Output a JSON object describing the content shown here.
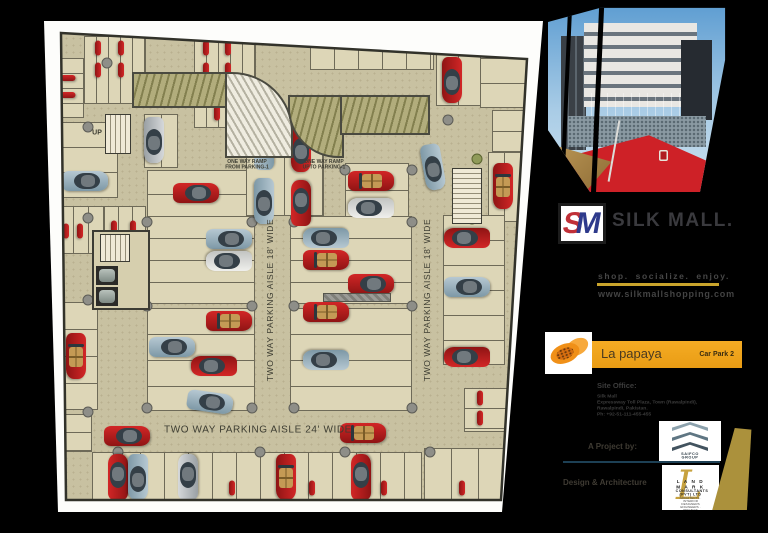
{
  "plan": {
    "aisle_labels": [
      {
        "text": "TWO WAY PARKING AISLE 18' WIDE",
        "x": 270,
        "y": 300,
        "rot": -90,
        "size": 8.5
      },
      {
        "text": "TWO WAY PARKING AISLE 18' WIDE",
        "x": 427,
        "y": 300,
        "rot": -90,
        "size": 8.5
      },
      {
        "text": "TWO WAY PARKING AISLE 24' WIDE",
        "x": 258,
        "y": 430,
        "rot": 0,
        "size": 10
      }
    ],
    "ramp_labels": [
      {
        "line1": "ONE WAY RAMP",
        "line2": "FROM PARKING-1",
        "x": 247,
        "y": 165
      },
      {
        "line1": "ONE WAY RAMP",
        "line2": "UPTO PARKING-1",
        "x": 324,
        "y": 165
      }
    ],
    "up_labels": [
      {
        "text": "UP",
        "x": 97,
        "y": 133
      },
      {
        "text": "UP",
        "x": 137,
        "y": 246
      },
      {
        "text": "UP",
        "x": 466,
        "y": 180
      }
    ],
    "banks": [
      [
        84,
        36,
        62,
        68,
        "v",
        12
      ],
      [
        194,
        36,
        62,
        92,
        "v",
        12
      ],
      [
        56,
        58,
        28,
        60,
        "h",
        15
      ],
      [
        56,
        122,
        62,
        76,
        "h",
        25
      ],
      [
        58,
        206,
        46,
        48,
        "v",
        15
      ],
      [
        104,
        206,
        42,
        48,
        "v",
        14
      ],
      [
        58,
        302,
        40,
        108,
        "h",
        27
      ],
      [
        56,
        414,
        36,
        38,
        "h",
        18
      ],
      [
        92,
        452,
        330,
        52,
        "v",
        24
      ],
      [
        424,
        448,
        82,
        54,
        "v",
        27
      ],
      [
        147,
        170,
        108,
        48,
        "h",
        24
      ],
      [
        144,
        114,
        34,
        54,
        "v",
        17
      ],
      [
        246,
        120,
        78,
        96,
        "v",
        38
      ],
      [
        345,
        163,
        64,
        94,
        "h",
        27
      ],
      [
        147,
        216,
        108,
        88,
        "h",
        22
      ],
      [
        290,
        216,
        122,
        88,
        "h",
        22
      ],
      [
        147,
        308,
        108,
        103,
        "h",
        26
      ],
      [
        290,
        308,
        122,
        103,
        "h",
        26
      ],
      [
        436,
        48,
        68,
        58,
        "v",
        22
      ],
      [
        480,
        58,
        52,
        50,
        "h",
        25
      ],
      [
        492,
        110,
        38,
        42,
        "h",
        21
      ],
      [
        488,
        152,
        34,
        70,
        "v",
        16
      ],
      [
        443,
        215,
        62,
        150,
        "h",
        25
      ],
      [
        464,
        388,
        44,
        44,
        "h",
        20
      ],
      [
        310,
        42,
        124,
        28,
        "v",
        24
      ]
    ],
    "vehicles": [
      [
        200,
        91,
        0,
        "conv",
        "red"
      ],
      [
        374,
        111,
        0,
        "sedan",
        "silver"
      ],
      [
        452,
        80,
        90,
        "sedan",
        "red"
      ],
      [
        154,
        140,
        90,
        "sedan",
        "silver"
      ],
      [
        503,
        186,
        90,
        "conv",
        "red"
      ],
      [
        264,
        147,
        270,
        "sedan",
        "blue"
      ],
      [
        301,
        149,
        90,
        "sedan",
        "red"
      ],
      [
        264,
        201,
        90,
        "sedan",
        "blue"
      ],
      [
        301,
        203,
        270,
        "sedan",
        "red"
      ],
      [
        371,
        181,
        0,
        "conv",
        "red"
      ],
      [
        371,
        208,
        180,
        "sedan",
        "white"
      ],
      [
        433,
        167,
        80,
        "sedan",
        "blue"
      ],
      [
        85,
        181,
        0,
        "sedan",
        "blue"
      ],
      [
        66,
        231,
        90,
        "bike",
        "red"
      ],
      [
        80,
        231,
        90,
        "bike",
        "red"
      ],
      [
        114,
        228,
        90,
        "bike",
        "red"
      ],
      [
        133,
        228,
        90,
        "bike",
        "red"
      ],
      [
        76,
        356,
        90,
        "conv",
        "red"
      ],
      [
        196,
        193,
        0,
        "sedan",
        "red"
      ],
      [
        229,
        239,
        0,
        "sedan",
        "blue"
      ],
      [
        229,
        261,
        180,
        "sedan",
        "white"
      ],
      [
        229,
        321,
        0,
        "conv",
        "red"
      ],
      [
        172,
        347,
        0,
        "sedan",
        "blue"
      ],
      [
        214,
        366,
        180,
        "sedan",
        "red"
      ],
      [
        326,
        238,
        180,
        "sedan",
        "blue"
      ],
      [
        326,
        260,
        0,
        "conv",
        "red"
      ],
      [
        326,
        312,
        0,
        "conv",
        "red"
      ],
      [
        326,
        360,
        180,
        "sedan",
        "blue"
      ],
      [
        371,
        284,
        0,
        "sedan",
        "red"
      ],
      [
        210,
        402,
        8,
        "sedan",
        "blue"
      ],
      [
        127,
        436,
        0,
        "sedan",
        "red"
      ],
      [
        363,
        433,
        0,
        "conv",
        "red"
      ],
      [
        467,
        238,
        180,
        "sedan",
        "red"
      ],
      [
        467,
        287,
        0,
        "sedan",
        "blue"
      ],
      [
        467,
        357,
        180,
        "sedan",
        "red"
      ],
      [
        480,
        398,
        90,
        "bike",
        "red"
      ],
      [
        480,
        418,
        90,
        "bike",
        "red"
      ],
      [
        118,
        477,
        270,
        "sedan",
        "red"
      ],
      [
        138,
        477,
        90,
        "sedan",
        "blue"
      ],
      [
        188,
        477,
        270,
        "sedan",
        "silver"
      ],
      [
        286,
        477,
        90,
        "conv",
        "red"
      ],
      [
        361,
        477,
        270,
        "sedan",
        "red"
      ],
      [
        232,
        488,
        90,
        "bike",
        "red"
      ],
      [
        312,
        488,
        90,
        "bike",
        "red"
      ],
      [
        384,
        488,
        90,
        "bike",
        "red"
      ],
      [
        462,
        488,
        90,
        "bike",
        "red"
      ],
      [
        98,
        48,
        90,
        "bike",
        "red"
      ],
      [
        121,
        48,
        90,
        "bike",
        "red"
      ],
      [
        98,
        70,
        90,
        "bike",
        "red"
      ],
      [
        121,
        70,
        90,
        "bike",
        "red"
      ],
      [
        206,
        48,
        90,
        "bike",
        "red"
      ],
      [
        228,
        48,
        90,
        "bike",
        "red"
      ],
      [
        206,
        70,
        90,
        "bike",
        "red"
      ],
      [
        228,
        70,
        90,
        "bike",
        "red"
      ],
      [
        217,
        93,
        90,
        "bike",
        "red"
      ],
      [
        217,
        113,
        90,
        "bike",
        "red"
      ],
      [
        68,
        78,
        0,
        "bike",
        "red"
      ],
      [
        68,
        95,
        0,
        "bike",
        "red"
      ]
    ],
    "columns": [
      [
        107,
        63
      ],
      [
        88,
        127
      ],
      [
        88,
        218
      ],
      [
        88,
        300
      ],
      [
        88,
        412
      ],
      [
        118,
        452
      ],
      [
        147,
        222
      ],
      [
        147,
        306
      ],
      [
        147,
        408
      ],
      [
        252,
        222
      ],
      [
        252,
        306
      ],
      [
        252,
        408
      ],
      [
        294,
        222
      ],
      [
        294,
        306
      ],
      [
        294,
        408
      ],
      [
        345,
        170
      ],
      [
        412,
        170
      ],
      [
        412,
        222
      ],
      [
        412,
        306
      ],
      [
        412,
        408
      ],
      [
        448,
        120
      ],
      [
        260,
        452
      ],
      [
        345,
        452
      ],
      [
        430,
        452
      ]
    ],
    "olive_columns": [
      [
        477,
        159
      ],
      [
        472,
        219
      ]
    ]
  },
  "panel": {
    "brand": {
      "monogram_s": "S",
      "monogram_m": "M",
      "name": "SILK MALL."
    },
    "tagline": "shop. socialize. enjoy.",
    "website": "www.silkmallshopping.com",
    "lapapaya": {
      "name": "La papaya",
      "sub": "Car Park 2"
    },
    "site_office": {
      "heading": "Site Office:",
      "lines": [
        "Silk Mall",
        "Expressway Toll Plaza, Town (Rawalpindi),",
        "Rawalpindi, Pakistan.",
        "Ph: +92-51-111-455-455"
      ]
    },
    "project": {
      "label": "A Project by:",
      "logo_text": "SAIFCO GROUP"
    },
    "design": {
      "label": "Design & Architecture",
      "monogram": "L",
      "logo_line1": "L A N D M A R K",
      "logo_line2": "CONSULTANTS (PVT) LTD",
      "logo_line3": "ARCHITECTS · INTERIOR DESIGNERS",
      "logo_line4": "ENGINEERS · PROJECT MANAGEMENT"
    }
  }
}
